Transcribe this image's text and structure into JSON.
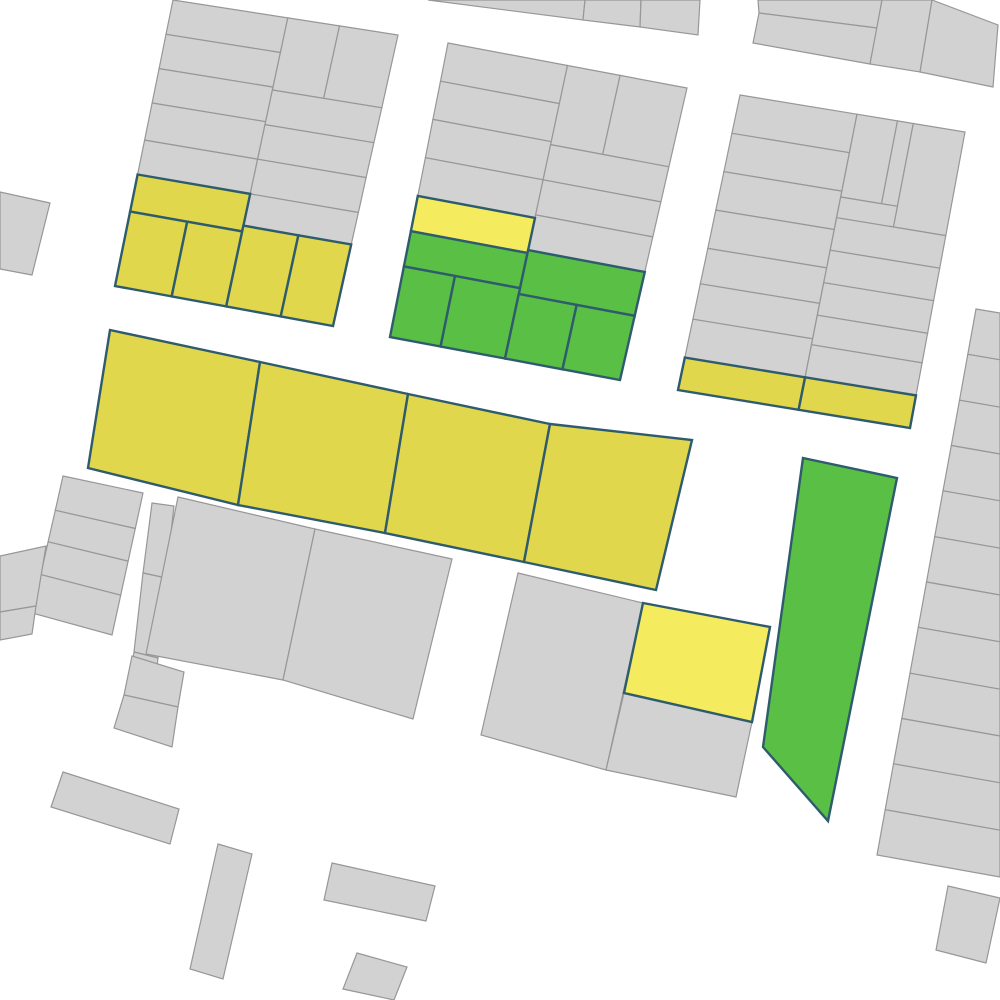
{
  "map": {
    "background": "#ffffff",
    "palette": {
      "gray": {
        "fill": "#d2d2d2",
        "stroke": "#979797",
        "stroke_width": 1.2
      },
      "yellow": {
        "fill": "#e0d74d",
        "stroke": "#2e5b6d",
        "stroke_width": 2.4
      },
      "bright_yellow": {
        "fill": "#f4eb5f",
        "stroke": "#2e5b6d",
        "stroke_width": 2.4
      },
      "green": {
        "fill": "#5abf45",
        "stroke": "#2e5b6d",
        "stroke_width": 2.4
      }
    },
    "grid_blocks": [
      {
        "name": "block-northwest",
        "quad": [
          [
            173,
            0
          ],
          [
            398,
            35
          ],
          [
            333,
            326
          ],
          [
            115,
            286
          ]
        ],
        "parcels": [
          [
            "gray",
            0,
            0,
            0.51,
            0.12
          ],
          [
            "gray",
            0,
            0.12,
            0.51,
            0.24
          ],
          [
            "gray",
            0,
            0.24,
            0.51,
            0.36
          ],
          [
            "gray",
            0,
            0.36,
            0.51,
            0.49
          ],
          [
            "gray",
            0,
            0.49,
            0.51,
            0.61
          ],
          [
            "gray",
            0.51,
            0,
            0.74,
            0.25
          ],
          [
            "gray",
            0.74,
            0,
            1,
            0.25
          ],
          [
            "gray",
            0.51,
            0.25,
            1,
            0.37
          ],
          [
            "gray",
            0.51,
            0.37,
            1,
            0.49
          ],
          [
            "gray",
            0.51,
            0.49,
            1,
            0.61
          ],
          [
            "gray",
            0.51,
            0.61,
            1,
            0.72
          ],
          [
            "yellow",
            0,
            0.61,
            0.51,
            0.74
          ],
          [
            "yellow",
            0,
            0.74,
            0.26,
            1
          ],
          [
            "yellow",
            0.26,
            0.74,
            0.51,
            1
          ],
          [
            "yellow",
            0.51,
            0.72,
            0.76,
            1
          ],
          [
            "yellow",
            0.76,
            0.72,
            1,
            1
          ]
        ]
      },
      {
        "name": "block-north-center",
        "quad": [
          [
            448,
            43
          ],
          [
            687,
            88
          ],
          [
            620,
            380
          ],
          [
            390,
            337
          ]
        ],
        "parcels": [
          [
            "gray",
            0,
            0,
            0.5,
            0.13
          ],
          [
            "gray",
            0,
            0.13,
            0.5,
            0.26
          ],
          [
            "gray",
            0,
            0.26,
            0.5,
            0.39
          ],
          [
            "gray",
            0,
            0.39,
            0.5,
            0.52
          ],
          [
            "gray",
            0.5,
            0,
            0.72,
            0.27
          ],
          [
            "gray",
            0.72,
            0,
            1,
            0.27
          ],
          [
            "gray",
            0.5,
            0.27,
            1,
            0.39
          ],
          [
            "gray",
            0.5,
            0.39,
            1,
            0.51
          ],
          [
            "gray",
            0.5,
            0.51,
            1,
            0.63
          ],
          [
            "bright_yellow",
            0,
            0.52,
            0.5,
            0.64
          ],
          [
            "green",
            0,
            0.64,
            0.5,
            0.76
          ],
          [
            "green",
            0.5,
            0.63,
            1,
            0.78
          ],
          [
            "green",
            0,
            0.76,
            0.22,
            1
          ],
          [
            "green",
            0.22,
            0.76,
            0.5,
            1
          ],
          [
            "green",
            0.5,
            0.78,
            0.75,
            1
          ],
          [
            "green",
            0.75,
            0.78,
            1,
            1
          ]
        ]
      },
      {
        "name": "block-northeast",
        "quad": [
          [
            740,
            95
          ],
          [
            965,
            132
          ],
          [
            910,
            428
          ],
          [
            678,
            390
          ]
        ],
        "parcels": [
          [
            "gray",
            0,
            0,
            0.52,
            0.13
          ],
          [
            "gray",
            0,
            0.13,
            0.52,
            0.26
          ],
          [
            "gray",
            0,
            0.26,
            0.52,
            0.39
          ],
          [
            "gray",
            0,
            0.39,
            0.52,
            0.52
          ],
          [
            "gray",
            0,
            0.52,
            0.52,
            0.64
          ],
          [
            "gray",
            0,
            0.64,
            0.52,
            0.76
          ],
          [
            "gray",
            0,
            0.76,
            0.52,
            0.89
          ],
          [
            "gray",
            0.52,
            0,
            0.7,
            0.28
          ],
          [
            "gray",
            0.7,
            0,
            0.77,
            0.28
          ],
          [
            "gray",
            0.77,
            0,
            1,
            0.35
          ],
          [
            "gray",
            0.52,
            0.28,
            0.77,
            0.35
          ],
          [
            "gray",
            0.52,
            0.35,
            1,
            0.46
          ],
          [
            "gray",
            0.52,
            0.46,
            1,
            0.57
          ],
          [
            "gray",
            0.52,
            0.57,
            1,
            0.68
          ],
          [
            "gray",
            0.52,
            0.68,
            1,
            0.78
          ],
          [
            "gray",
            0.52,
            0.78,
            1,
            0.89
          ],
          [
            "yellow",
            0,
            0.89,
            0.52,
            1
          ],
          [
            "yellow",
            0.52,
            0.89,
            1,
            1
          ]
        ]
      },
      {
        "name": "block-east-strips",
        "quad": [
          [
            976,
            309
          ],
          [
            1000,
            313
          ],
          [
            1000,
            877
          ],
          [
            877,
            855
          ]
        ],
        "parcels": [
          [
            "gray",
            0,
            0,
            1,
            0.083
          ],
          [
            "gray",
            0,
            0.083,
            1,
            0.167
          ],
          [
            "gray",
            0,
            0.167,
            1,
            0.25
          ],
          [
            "gray",
            0,
            0.25,
            1,
            0.333
          ],
          [
            "gray",
            0,
            0.333,
            1,
            0.417
          ],
          [
            "gray",
            0,
            0.417,
            1,
            0.5
          ],
          [
            "gray",
            0,
            0.5,
            1,
            0.583
          ],
          [
            "gray",
            0,
            0.583,
            1,
            0.667
          ],
          [
            "gray",
            0,
            0.667,
            1,
            0.75
          ],
          [
            "gray",
            0,
            0.75,
            1,
            0.833
          ],
          [
            "gray",
            0,
            0.833,
            1,
            0.917
          ],
          [
            "gray",
            0,
            0.917,
            1,
            1
          ]
        ]
      },
      {
        "name": "block-west-strips",
        "quad": [
          [
            63,
            476
          ],
          [
            143,
            493
          ],
          [
            112,
            635
          ],
          [
            32,
            613
          ]
        ],
        "parcels": [
          [
            "gray",
            0,
            0,
            1,
            0.25
          ],
          [
            "gray",
            0,
            0.25,
            1,
            0.48
          ],
          [
            "gray",
            0,
            0.48,
            1,
            0.72
          ],
          [
            "gray",
            0,
            0.72,
            1,
            1
          ]
        ]
      }
    ],
    "polygons": [
      {
        "name": "top-sliver-parcel-1",
        "color": "gray",
        "points": [
          [
            428,
            0
          ],
          [
            585,
            0
          ],
          [
            583,
            20
          ]
        ]
      },
      {
        "name": "top-sliver-parcel-2",
        "color": "gray",
        "points": [
          [
            585,
            0
          ],
          [
            641,
            0
          ],
          [
            640,
            27
          ],
          [
            583,
            20
          ]
        ]
      },
      {
        "name": "top-sliver-parcel-3",
        "color": "gray",
        "points": [
          [
            641,
            0
          ],
          [
            700,
            0
          ],
          [
            698,
            35
          ],
          [
            640,
            27
          ]
        ]
      },
      {
        "name": "top-right-parcel-1",
        "color": "gray",
        "points": [
          [
            758,
            0
          ],
          [
            882,
            0
          ],
          [
            877,
            28
          ],
          [
            759,
            13
          ]
        ]
      },
      {
        "name": "top-right-parcel-2",
        "color": "gray",
        "points": [
          [
            759,
            13
          ],
          [
            877,
            28
          ],
          [
            870,
            64
          ],
          [
            753,
            43
          ]
        ]
      },
      {
        "name": "top-right-parcel-3",
        "color": "gray",
        "points": [
          [
            882,
            0
          ],
          [
            932,
            0
          ],
          [
            920,
            72
          ],
          [
            870,
            64
          ]
        ]
      },
      {
        "name": "top-right-parcel-4",
        "color": "gray",
        "points": [
          [
            932,
            0
          ],
          [
            998,
            25
          ],
          [
            993,
            87
          ],
          [
            920,
            72
          ]
        ]
      },
      {
        "name": "west-edge-parcel",
        "color": "gray",
        "points": [
          [
            0,
            192
          ],
          [
            50,
            203
          ],
          [
            32,
            275
          ],
          [
            0,
            269
          ]
        ]
      },
      {
        "name": "yellow-row-parcel-1",
        "color": "yellow",
        "points": [
          [
            110,
            330
          ],
          [
            260,
            362
          ],
          [
            238,
            505
          ],
          [
            88,
            468
          ]
        ]
      },
      {
        "name": "yellow-row-parcel-2",
        "color": "yellow",
        "points": [
          [
            260,
            362
          ],
          [
            408,
            394
          ],
          [
            385,
            533
          ],
          [
            238,
            505
          ]
        ]
      },
      {
        "name": "yellow-row-parcel-3",
        "color": "yellow",
        "points": [
          [
            408,
            394
          ],
          [
            550,
            424
          ],
          [
            524,
            562
          ],
          [
            385,
            533
          ]
        ]
      },
      {
        "name": "yellow-row-parcel-4",
        "color": "yellow",
        "points": [
          [
            550,
            424
          ],
          [
            692,
            440
          ],
          [
            656,
            590
          ],
          [
            524,
            562
          ]
        ]
      },
      {
        "name": "west-edge-small-1",
        "color": "gray",
        "points": [
          [
            0,
            556
          ],
          [
            46,
            546
          ],
          [
            36,
            606
          ],
          [
            0,
            612
          ]
        ]
      },
      {
        "name": "west-edge-small-2",
        "color": "gray",
        "points": [
          [
            0,
            612
          ],
          [
            36,
            606
          ],
          [
            32,
            634
          ],
          [
            0,
            640
          ]
        ]
      },
      {
        "name": "narrow-column-parcel-1",
        "color": "gray",
        "points": [
          [
            152,
            503
          ],
          [
            174,
            506
          ],
          [
            166,
            578
          ],
          [
            143,
            573
          ]
        ]
      },
      {
        "name": "narrow-column-parcel-2",
        "color": "gray",
        "points": [
          [
            143,
            573
          ],
          [
            166,
            578
          ],
          [
            158,
            658
          ],
          [
            134,
            652
          ]
        ]
      },
      {
        "name": "narrow-column-stub",
        "color": "gray",
        "points": [
          [
            134,
            652
          ],
          [
            158,
            658
          ],
          [
            156,
            676
          ],
          [
            131,
            671
          ]
        ]
      },
      {
        "name": "center-west-parcel-1",
        "color": "gray",
        "points": [
          [
            178,
            497
          ],
          [
            315,
            529
          ],
          [
            283,
            680
          ],
          [
            146,
            654
          ]
        ]
      },
      {
        "name": "center-west-parcel-2",
        "color": "gray",
        "points": [
          [
            315,
            529
          ],
          [
            452,
            559
          ],
          [
            413,
            719
          ],
          [
            283,
            680
          ]
        ]
      },
      {
        "name": "tilted-pair-parcel-1",
        "color": "gray",
        "points": [
          [
            132,
            656
          ],
          [
            184,
            672
          ],
          [
            178,
            707
          ],
          [
            124,
            695
          ]
        ]
      },
      {
        "name": "tilted-pair-parcel-2",
        "color": "gray",
        "points": [
          [
            124,
            695
          ],
          [
            178,
            707
          ],
          [
            172,
            747
          ],
          [
            114,
            728
          ]
        ]
      },
      {
        "name": "center-south-gray-square",
        "color": "gray",
        "points": [
          [
            518,
            573
          ],
          [
            643,
            603
          ],
          [
            606,
            770
          ],
          [
            481,
            735
          ]
        ]
      },
      {
        "name": "center-south-yellow-parcel",
        "color": "bright_yellow",
        "points": [
          [
            643,
            603
          ],
          [
            770,
            627
          ],
          [
            752,
            722
          ],
          [
            624,
            693
          ]
        ]
      },
      {
        "name": "center-south-gray-lower",
        "color": "gray",
        "points": [
          [
            624,
            693
          ],
          [
            752,
            722
          ],
          [
            736,
            797
          ],
          [
            606,
            770
          ]
        ]
      },
      {
        "name": "green-column-parcel",
        "color": "green",
        "points": [
          [
            803,
            458
          ],
          [
            897,
            478
          ],
          [
            828,
            821
          ],
          [
            763,
            747
          ]
        ]
      },
      {
        "name": "southeast-corner-parcel",
        "color": "gray",
        "points": [
          [
            948,
            886
          ],
          [
            1000,
            898
          ],
          [
            986,
            963
          ],
          [
            936,
            950
          ]
        ]
      },
      {
        "name": "south-building-bar",
        "color": "gray",
        "points": [
          [
            63,
            772
          ],
          [
            179,
            809
          ],
          [
            170,
            844
          ],
          [
            51,
            807
          ]
        ]
      },
      {
        "name": "south-building-tall",
        "color": "gray",
        "points": [
          [
            218,
            844
          ],
          [
            252,
            854
          ],
          [
            223,
            979
          ],
          [
            190,
            969
          ]
        ]
      },
      {
        "name": "south-building-wide",
        "color": "gray",
        "points": [
          [
            332,
            863
          ],
          [
            435,
            886
          ],
          [
            426,
            921
          ],
          [
            324,
            900
          ]
        ]
      },
      {
        "name": "south-building-square",
        "color": "gray",
        "points": [
          [
            357,
            953
          ],
          [
            407,
            967
          ],
          [
            394,
            1000
          ],
          [
            343,
            989
          ]
        ]
      }
    ]
  }
}
